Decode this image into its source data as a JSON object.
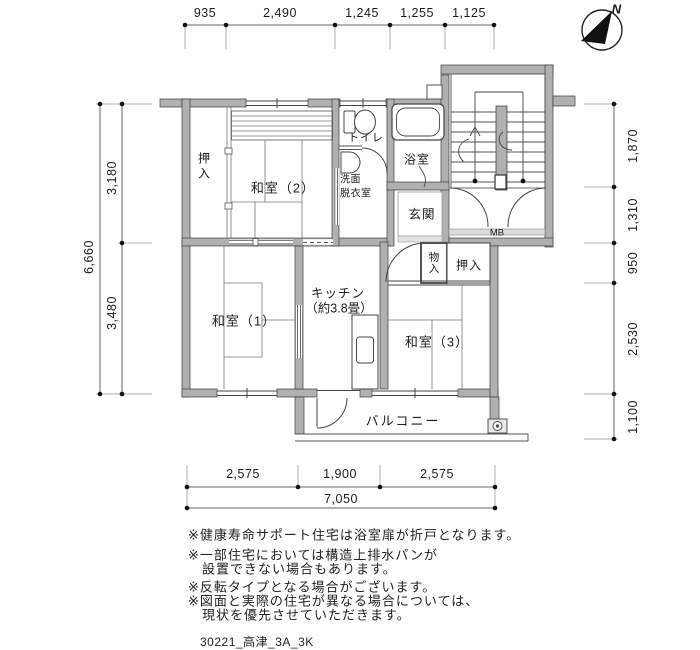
{
  "compass": {
    "north": "N"
  },
  "dims": {
    "top": [
      "935",
      "2,490",
      "1,245",
      "1,255",
      "1,125"
    ],
    "left_total": "6,660",
    "left": [
      "3,180",
      "3,480"
    ],
    "right": [
      "1,870",
      "1,310",
      "950",
      "2,530",
      "1,100"
    ],
    "bottom": [
      "2,575",
      "1,900",
      "2,575"
    ],
    "bottom_total": "7,050"
  },
  "rooms": {
    "oshiire_left": "押入",
    "washitsu2": "和室（2）",
    "toilet": "トイレ",
    "senmen_line1": "洗面",
    "senmen_line2": "脱衣室",
    "bath": "浴室",
    "genkan": "玄関",
    "mb": "MB",
    "monoire": "物入",
    "oshiire_right": "押入",
    "kitchen_line1": "キッチン",
    "kitchen_line2": "（約3.8畳）",
    "washitsu1": "和室（1）",
    "washitsu3": "和室（3）",
    "balcony": "バルコニー"
  },
  "notes": [
    "※健康寿命サポート住宅は浴室扉が折戸となります。",
    "※一部住宅においては構造上排水パンが",
    "　設置できない場合もあります。",
    "※反転タイプとなる場合がございます。",
    "※図面と実際の住宅が異なる場合については、",
    "　現状を優先させていただきます。"
  ],
  "footer": "30221_高津_3A_3K"
}
